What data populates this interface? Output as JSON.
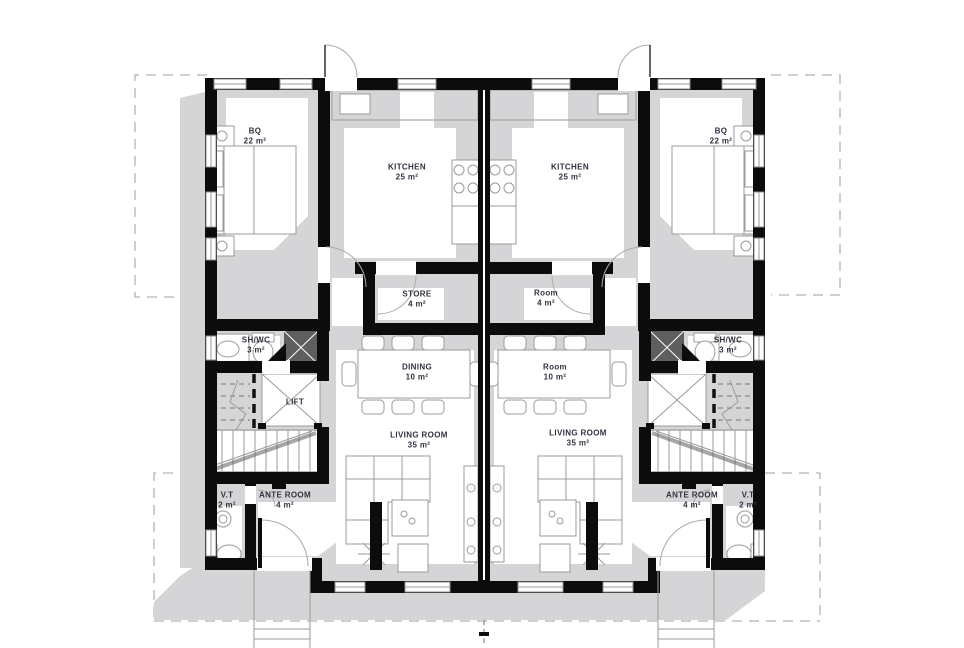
{
  "title": "Duplex ground floor plan",
  "units": {
    "left": {
      "rooms": [
        {
          "name": "BQ",
          "area": "22 m²"
        },
        {
          "name": "KITCHEN",
          "area": "25 m²"
        },
        {
          "name": "STORE",
          "area": "4 m²"
        },
        {
          "name": "SH/WC",
          "area": "3 m²"
        },
        {
          "name": "LIFT",
          "area": ""
        },
        {
          "name": "DINING",
          "area": "10 m²"
        },
        {
          "name": "LIVING ROOM",
          "area": "35 m²"
        },
        {
          "name": "ANTE ROOM",
          "area": "4 m²"
        },
        {
          "name": "V.T",
          "area": "2 m²"
        }
      ]
    },
    "right": {
      "rooms": [
        {
          "name": "KITCHEN",
          "area": "25 m²"
        },
        {
          "name": "BQ",
          "area": "22 m²"
        },
        {
          "name": "Room",
          "area": "4 m²"
        },
        {
          "name": "SH/WC",
          "area": "3 m²"
        },
        {
          "name": "Room",
          "area": "10 m²"
        },
        {
          "name": "LIVING ROOM",
          "area": "35 m²"
        },
        {
          "name": "ANTE ROOM",
          "area": "4 m²"
        },
        {
          "name": "V.T",
          "area": "2 m²"
        }
      ]
    }
  },
  "colors": {
    "walls": "#0c0c0d",
    "shadow": "#d5d5d7",
    "text": "#2f3340",
    "background": "#ffffff"
  }
}
